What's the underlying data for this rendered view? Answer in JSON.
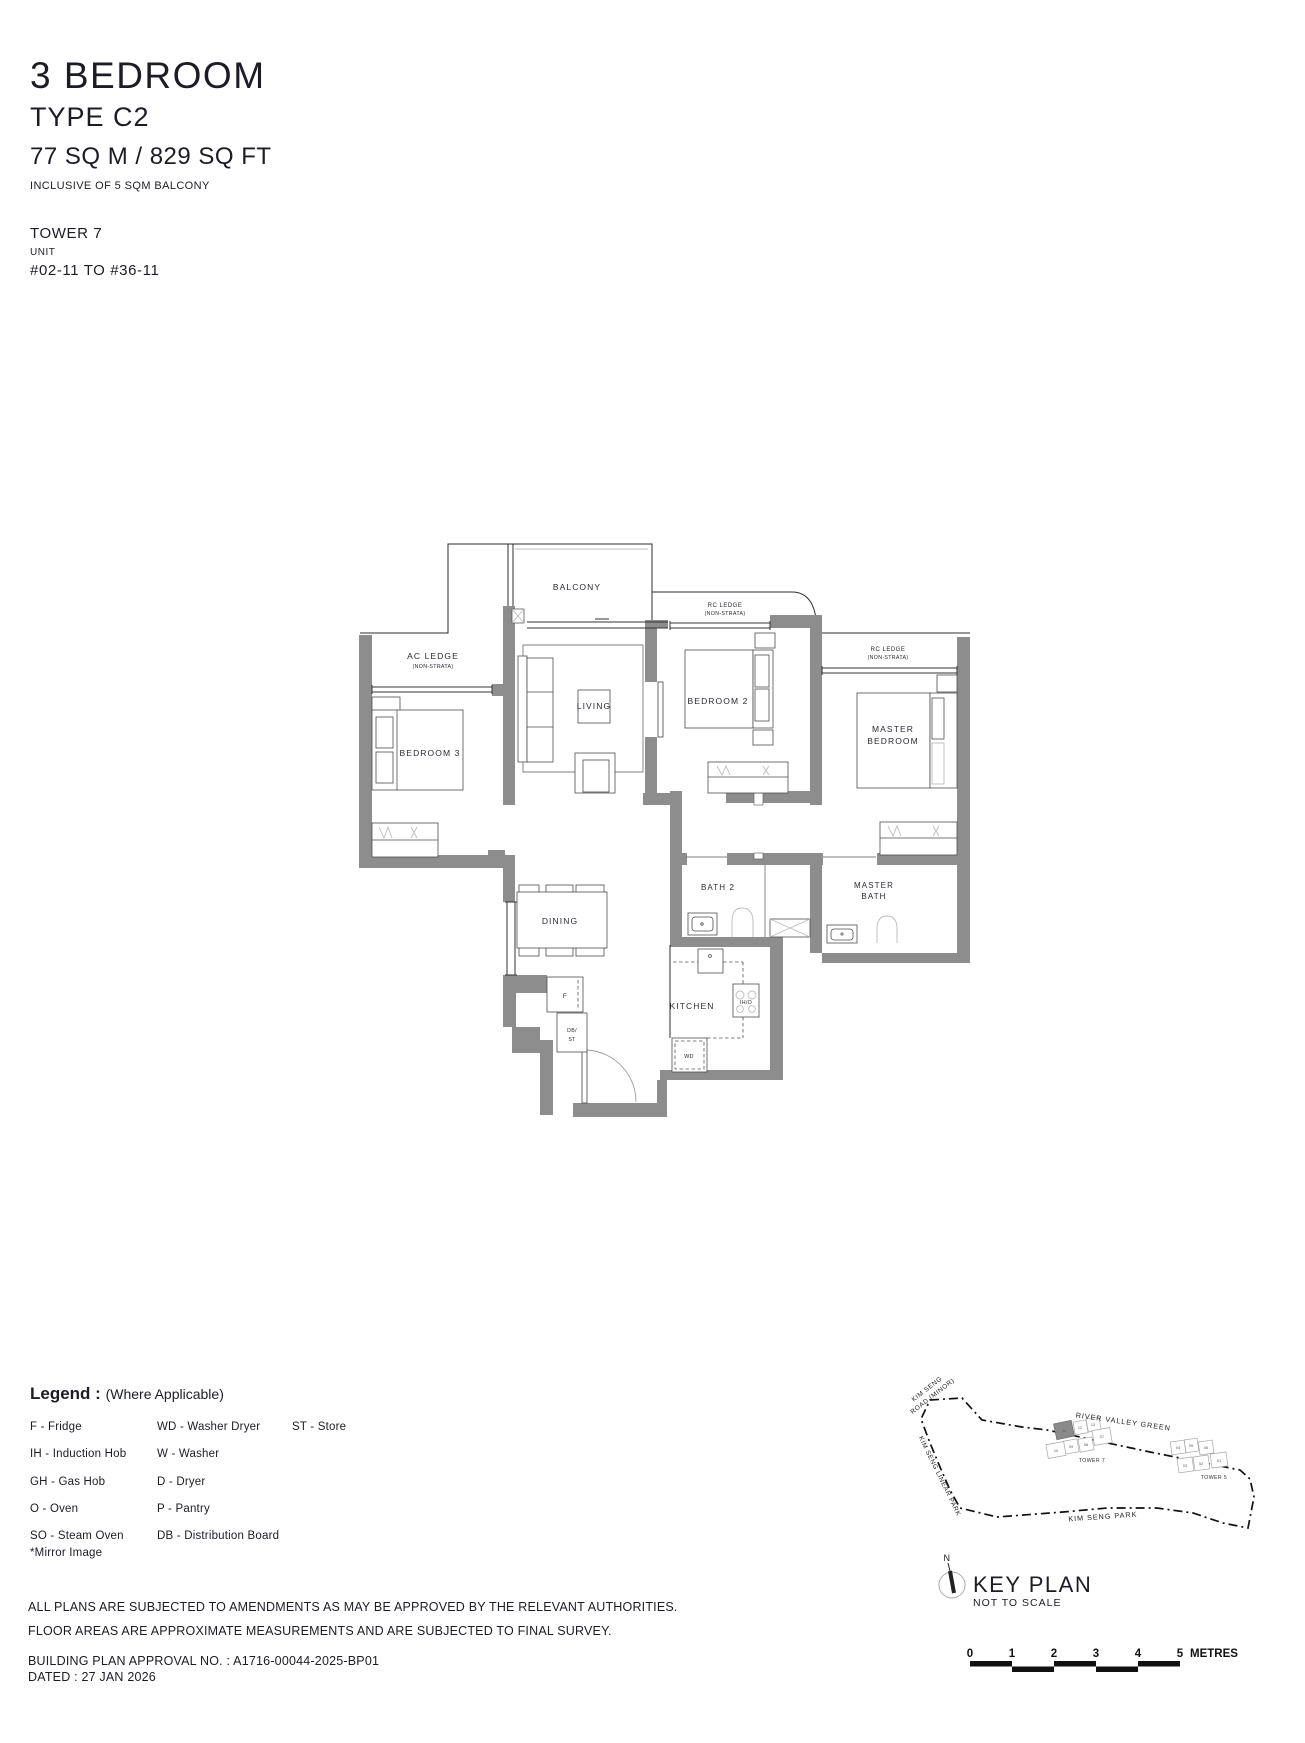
{
  "header": {
    "title": "3 BEDROOM",
    "subtitle": "TYPE C2",
    "area": "77 SQ M / 829 SQ FT",
    "area_note": "INCLUSIVE OF 5 SQM BALCONY",
    "tower": "TOWER 7",
    "unit_label": "UNIT",
    "unit_range": "#02-11 TO #36-11"
  },
  "plan": {
    "rooms": {
      "balcony": "BALCONY",
      "living": "LIVING",
      "dining": "DINING",
      "kitchen": "KITCHEN",
      "bedroom2": "BEDROOM 2",
      "bedroom3": "BEDROOM 3",
      "master_line1": "MASTER",
      "master_line2": "BEDROOM",
      "bath2": "BATH 2",
      "master_bath_line1": "MASTER",
      "master_bath_line2": "BATH"
    },
    "ledges": {
      "ac_ledge": "AC LEDGE",
      "rc_ledge": "RC LEDGE",
      "non_strata": "(NON-STRATA)"
    },
    "appliances": {
      "fridge": "F",
      "db": "DB/",
      "st": "ST",
      "hob": "IH/O",
      "washer_dryer": "WD"
    }
  },
  "legend": {
    "heading": "Legend :",
    "heading_note": "(Where Applicable)",
    "col1": [
      "F - Fridge",
      "IH - Induction Hob",
      "GH - Gas Hob",
      "O - Oven",
      "SO - Steam Oven"
    ],
    "col2": [
      "WD - Washer Dryer",
      "W - Washer",
      "D - Dryer",
      "P - Pantry",
      "DB - Distribution Board"
    ],
    "col3": [
      "ST - Store"
    ],
    "note": "*Mirror Image"
  },
  "keyplan": {
    "roads": {
      "kim_seng_road_1": "KIM SENG",
      "kim_seng_road_2": "ROAD (MINOR)",
      "river_valley_green": "RIVER VALLEY GREEN",
      "kim_seng_linear_park": "KIM SENG LINEAR PARK",
      "kim_seng_park": "KIM SENG PARK"
    },
    "tower7_label": "TOWER 7",
    "tower5_label": "TOWER 5",
    "tower7_units": [
      "11",
      "12",
      "13",
      "07",
      "08",
      "09",
      "10"
    ],
    "tower5_units": [
      "04",
      "05",
      "06",
      "03",
      "02",
      "01"
    ],
    "north": "N",
    "title": "KEY PLAN",
    "subtitle": "NOT TO SCALE"
  },
  "footer": {
    "disclaimer1": "ALL PLANS ARE SUBJECTED TO AMENDMENTS AS MAY BE APPROVED BY THE RELEVANT AUTHORITIES.",
    "disclaimer2": "FLOOR AREAS ARE APPROXIMATE MEASUREMENTS AND ARE SUBJECTED TO FINAL SURVEY.",
    "approval": "BUILDING PLAN APPROVAL NO. : A1716-00044-2025-BP01",
    "dated": "DATED : 27 JAN 2026"
  },
  "scalebar": {
    "t0": "0",
    "t1": "1",
    "t2": "2",
    "t3": "3",
    "t4": "4",
    "t5": "5",
    "unit": "METRES"
  },
  "colors": {
    "wall": "#8d8d8d",
    "line": "#2e2e2e",
    "text": "#1c1c26",
    "furniture": "#4d4d4d",
    "light_detail": "#bcbcbc"
  }
}
